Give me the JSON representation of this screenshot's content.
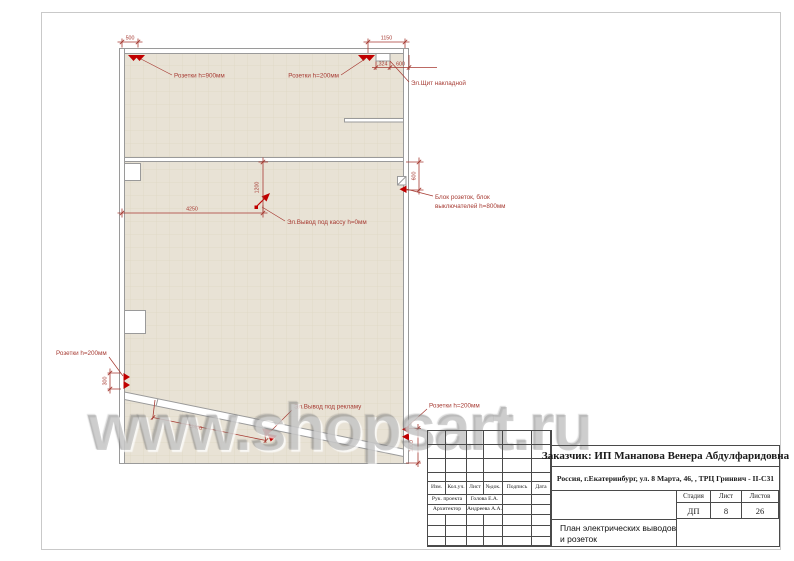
{
  "page": {
    "watermark": "www.shopsart.ru"
  },
  "plan": {
    "colors": {
      "fill": "#e8e2d5",
      "wall": "#9a9a9a",
      "annotation": "#a63a32",
      "symbol": "#c00000"
    },
    "dims": {
      "top_left": "500",
      "top_right": "1150",
      "panel_offset": "324",
      "panel_width": "600",
      "cash_x": "4250",
      "cash_y": "1200",
      "block_offset": "600",
      "left_sockets": "300",
      "showcase": "3400",
      "right_sockets": "1000"
    },
    "labels": {
      "sockets_900": "Розетки h=900мм",
      "sockets_200_top": "Розетки h=200мм",
      "panel": "Эл.Щит накладной",
      "block_line1": "Блок розеток, блок",
      "block_line2": "выключателей h=800мм",
      "cash_outlet": "Эл.Вывод под кассу h=0мм",
      "sockets_200_left": "Розетки h=200мм",
      "ad_outlet": "Эл.Вывод под рекламу",
      "sockets_200_right": "Розетки h=200мм"
    }
  },
  "titleblock": {
    "customer": "Заказчик:  ИП Манапова Венера Абдулфаридовна",
    "address": "Россия, г.Екатеринбург, ул. 8 Марта, 46, , ТРЦ Гринвич - II-С31",
    "header_cols": [
      "Изм.",
      "Кол.уч.",
      "Лист",
      "№док.",
      "Подпись",
      "Дата"
    ],
    "roles": [
      {
        "role": "Рук. проекта",
        "name": "Голова Е.А."
      },
      {
        "role": "Архитектор",
        "name": "Андреева А.А."
      }
    ],
    "stage_label": "Стадия",
    "sheet_label": "Лист",
    "sheets_label": "Листов",
    "stage": "ДП",
    "sheet": "8",
    "sheets": "26",
    "title_line1": "План электрических выводов",
    "title_line2": "и розеток"
  }
}
